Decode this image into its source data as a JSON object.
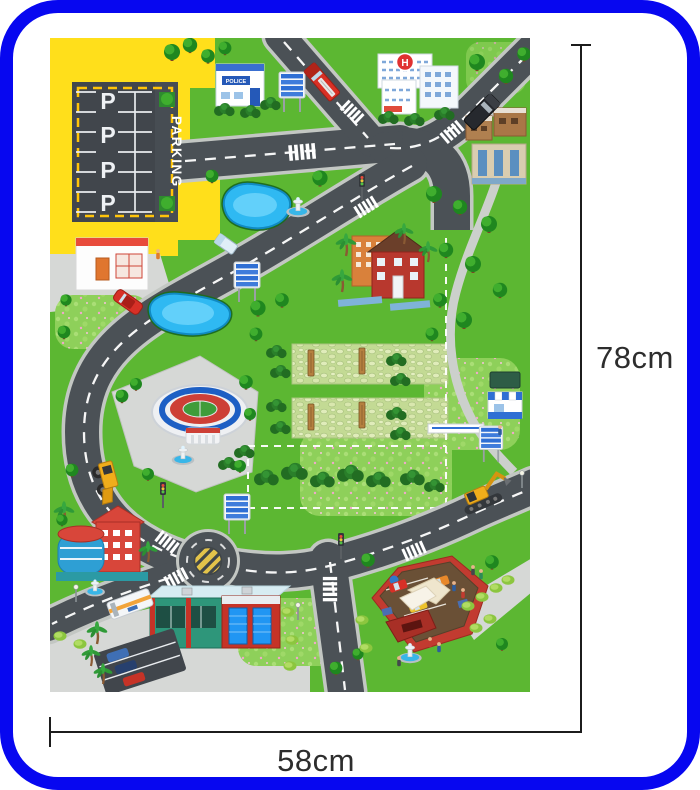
{
  "annotations": {
    "height_label": "78cm",
    "width_label": "58cm"
  },
  "mat": {
    "parking_sign": "PARKING",
    "parking_letter": "P",
    "police_sign": "POLICE",
    "hospital_letter": "H"
  },
  "colors": {
    "frame_blue": "#0707f0",
    "grass_green": "#5cb732",
    "road_gray": "#4b5156",
    "zone_yellow": "#ffdf1b",
    "pond_blue": "#2fb9f2",
    "dimension_line": "#1c1c1c"
  }
}
